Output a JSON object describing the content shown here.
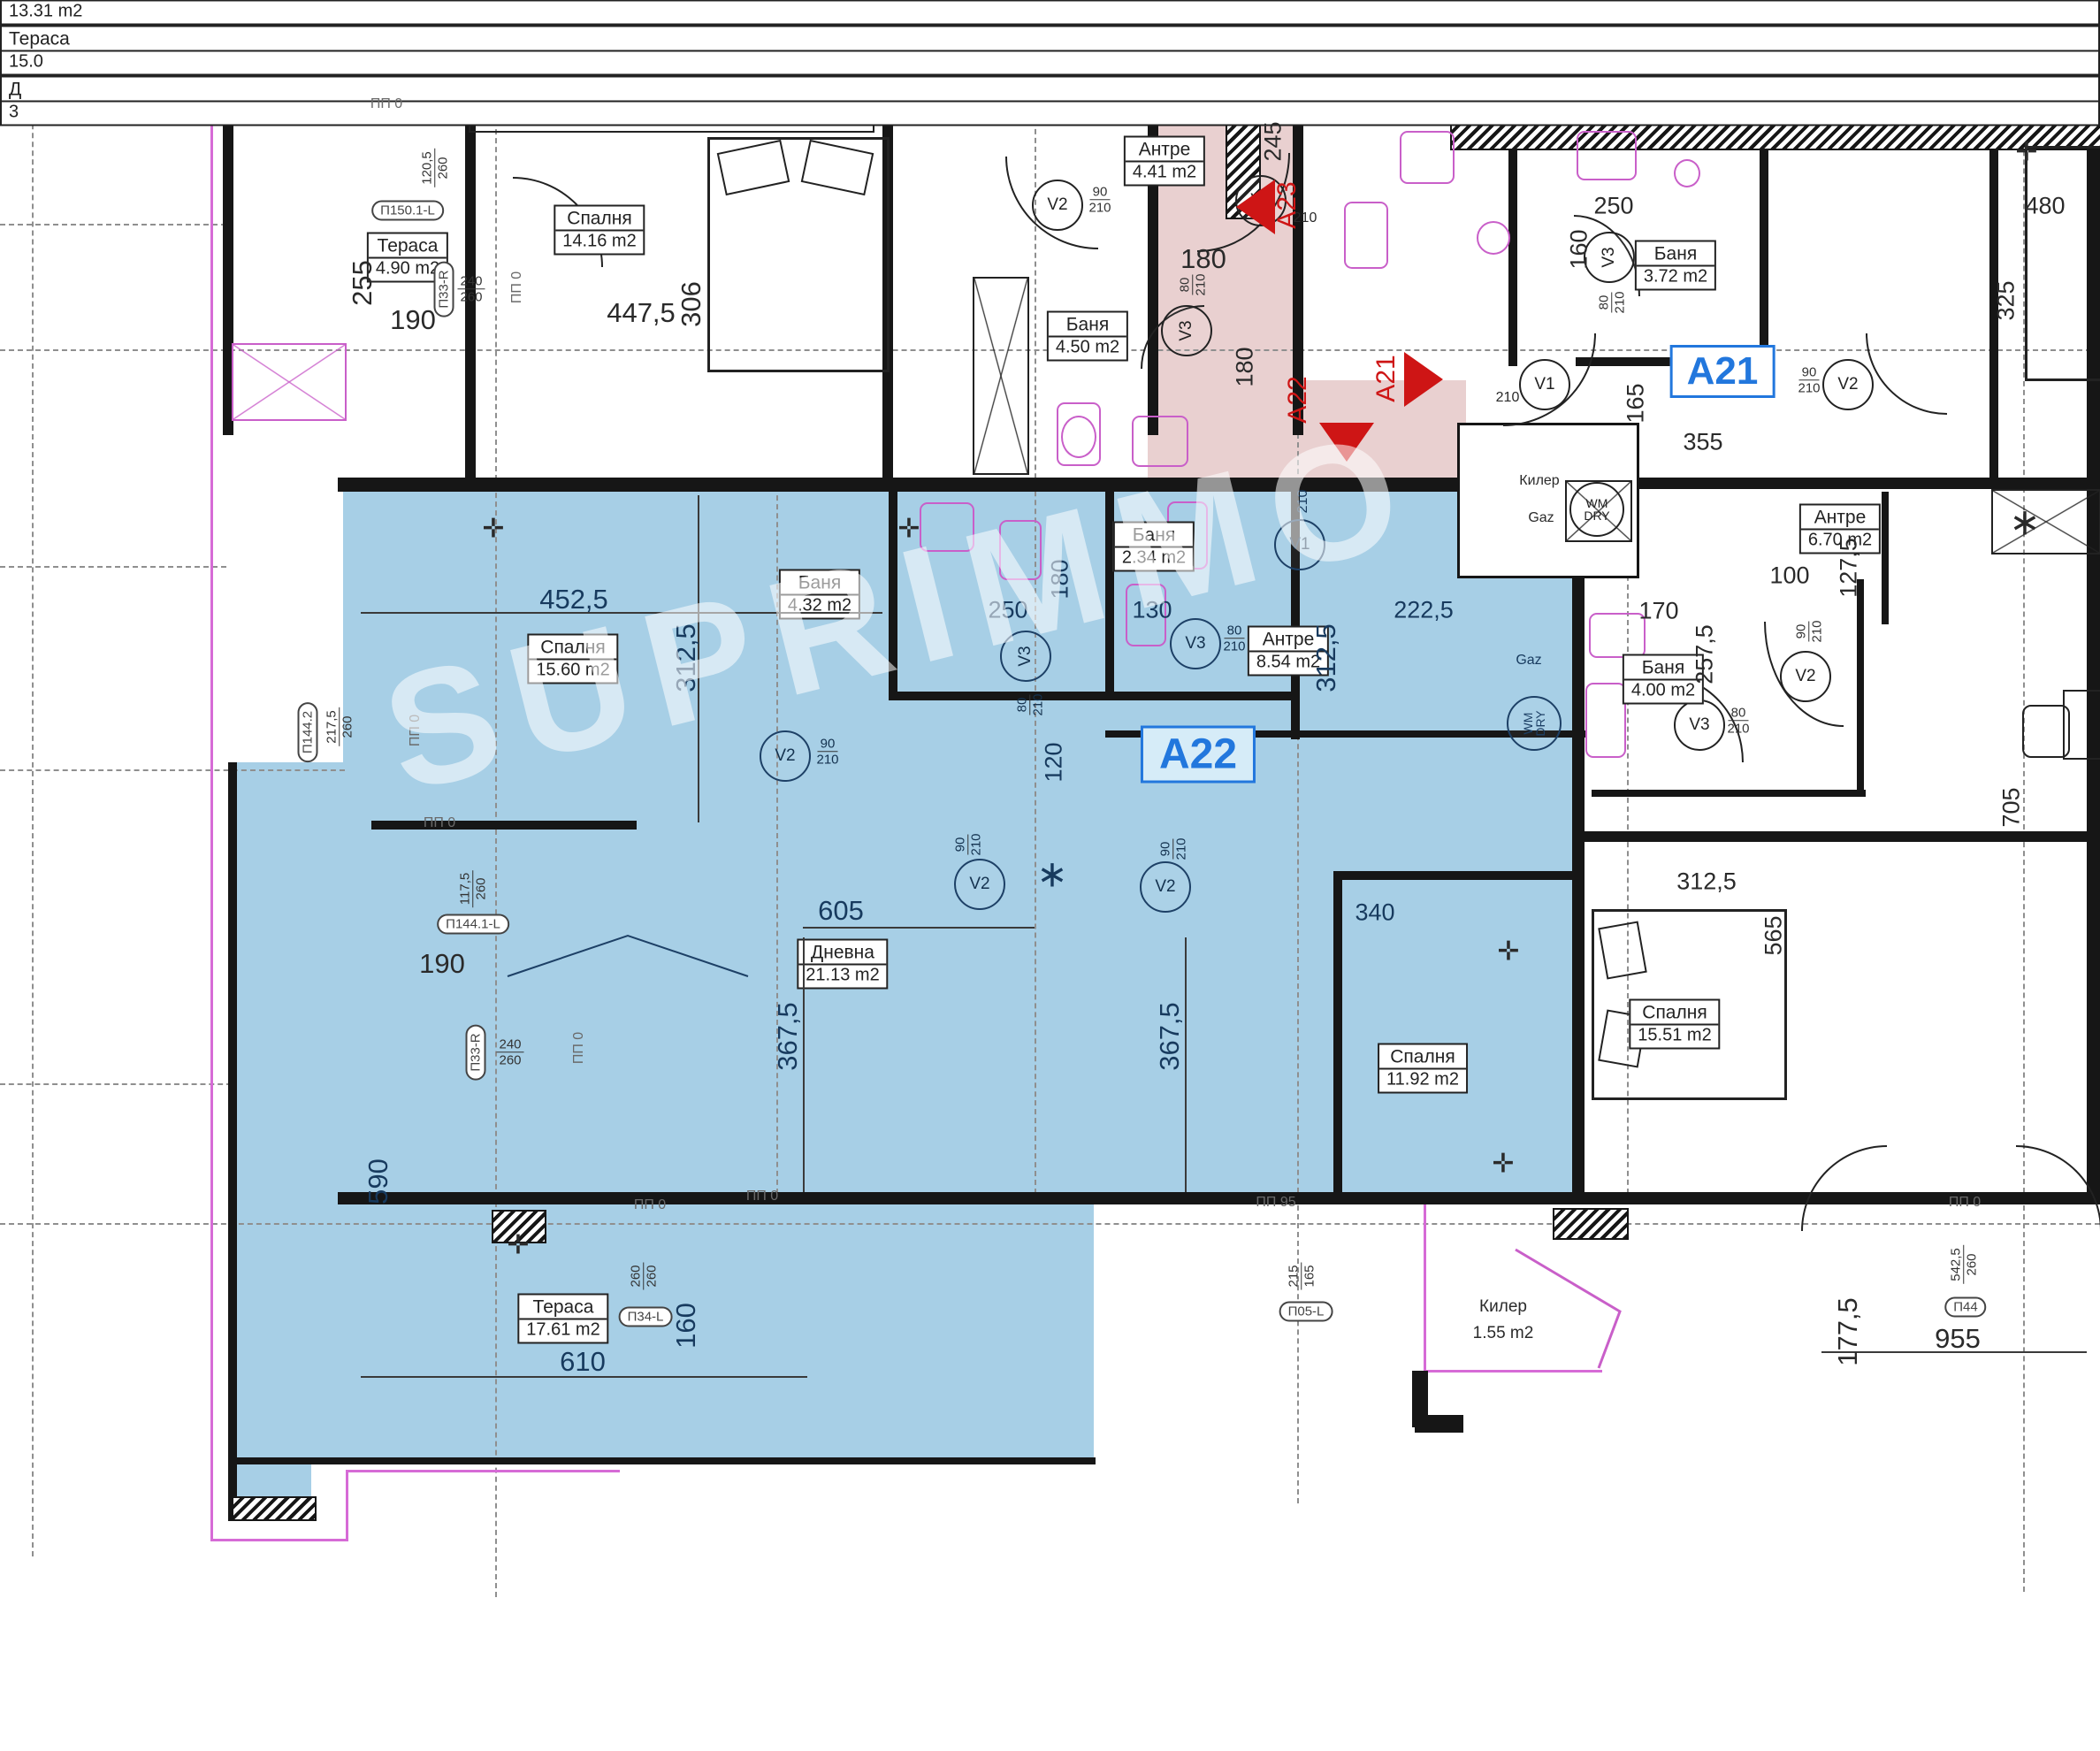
{
  "watermark": "SUPRIMMO",
  "units": {
    "a23": {
      "id": "A23",
      "level": "А +0,00",
      "area": "46.83 m2"
    },
    "a21": {
      "id": "A21"
    },
    "a22": {
      "id": "A22"
    }
  },
  "stairs": {
    "note": "18ст. x 16.7 x 30"
  },
  "rooms": {
    "terasa_nw": {
      "name": "Тераса",
      "area": "4.90 m2"
    },
    "spalnya_nw": {
      "name": "Спалня",
      "area": "14.16 m2"
    },
    "banya_450": {
      "name": "Баня",
      "area": "4.50 m2"
    },
    "antre_441": {
      "name": "Антре",
      "area": "4.41 m2"
    },
    "banya_372": {
      "name": "Баня",
      "area": "3.72 m2"
    },
    "spalnya_1331": {
      "name": "Спалня",
      "area": "13.31 m2"
    },
    "antre_670": {
      "name": "Антре",
      "area": "6.70 m2"
    },
    "banya_400": {
      "name": "Баня",
      "area": "4.00 m2"
    },
    "spalnya_1551": {
      "name": "Спалня",
      "area": "15.51 m2"
    },
    "spalnya_1560": {
      "name": "Спалня",
      "area": "15.60 m2"
    },
    "banya_432": {
      "name": "Баня",
      "area": "4.32 m2"
    },
    "banya_234": {
      "name": "Баня",
      "area": "2.34 m2"
    },
    "antre_854": {
      "name": "Антре",
      "area": "8.54 m2"
    },
    "dnevna": {
      "name": "Дневна",
      "area": "21.13 m2"
    },
    "spalnya_1192": {
      "name": "Спалня",
      "area": "11.92 m2"
    },
    "terasa_sw": {
      "name": "Тераса",
      "area": "17.61 m2"
    },
    "kiler": {
      "name": "Килер",
      "area": "1.55 m2"
    },
    "kiler_shaft": {
      "name": "Килер"
    },
    "terasa_se": {
      "name": "Тераса",
      "area": "15.0"
    },
    "dnevna_e": {
      "name": "Д",
      "area": "3"
    }
  },
  "utilities": {
    "gaz": "Gaz",
    "wm": "WM",
    "dry": "DRY"
  },
  "vents": {
    "v1": "V1",
    "v2": "V2",
    "v3": "V3"
  },
  "doors": {
    "w90": "90",
    "w80": "80",
    "h210": "210"
  },
  "dims": {
    "d100": "100",
    "d117_5": "117,5",
    "d120": "120",
    "d120_5": "120,5",
    "d127_5": "127,5",
    "d130": "130",
    "d160": "160",
    "d165": "165",
    "d170": "170",
    "d177_5": "177,5",
    "d180": "180",
    "d190": "190",
    "d215": "215",
    "d217_5": "217,5",
    "d222_5": "222,5",
    "d240": "240",
    "d245": "245",
    "d250": "250",
    "d255": "255",
    "d257_5": "257,5",
    "d260": "260",
    "d306": "306",
    "d312_5": "312,5",
    "d325": "325",
    "d340": "340",
    "d355": "355",
    "d367_5": "367,5",
    "d447_5": "447,5",
    "d452_5": "452,5",
    "d480": "480",
    "d542_5": "542,5",
    "d565": "565",
    "d590": "590",
    "d605": "605",
    "d610": "610",
    "d705": "705",
    "d955": "955"
  },
  "tags": {
    "p150": "П150.1-L",
    "p33r": "П33-R",
    "p34l": "П34-L",
    "p05l": "П05-L",
    "p44": "П44",
    "p144_1": "П144.1-L",
    "p144_2": "П144.2",
    "pp0": "ПП 0",
    "pp95": "ПП 95"
  }
}
